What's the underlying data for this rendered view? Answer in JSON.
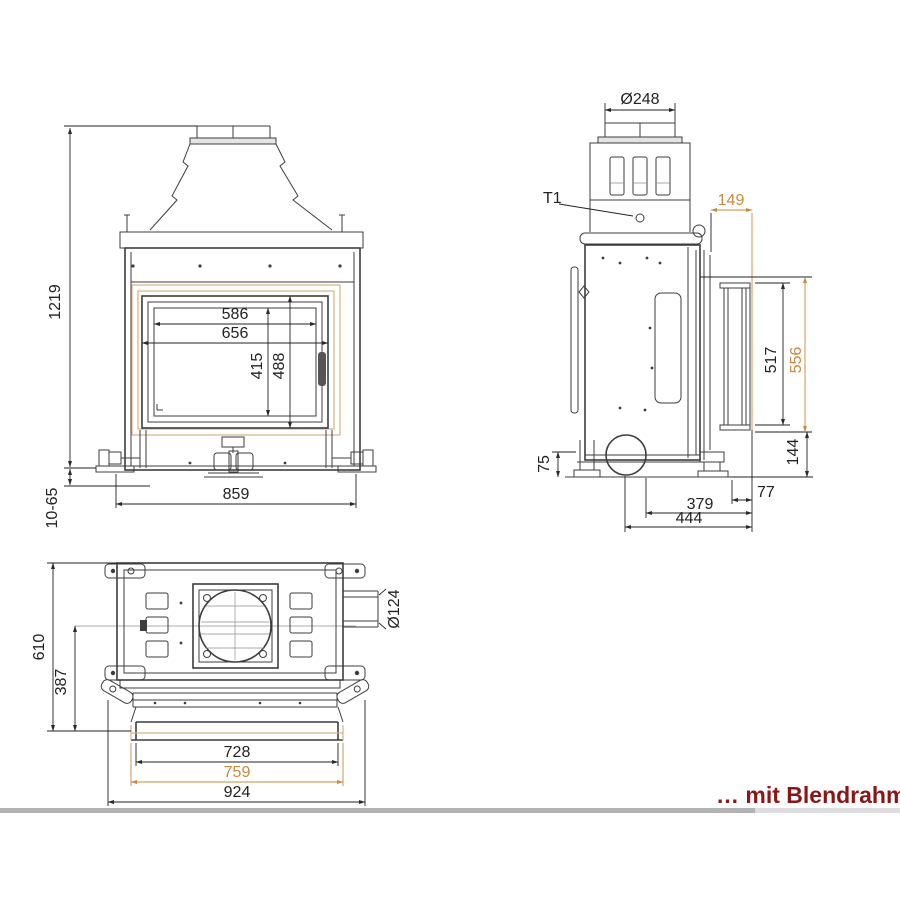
{
  "colors": {
    "line": "#3d3d3d",
    "dim_text": "#222222",
    "accent": "#c8883f",
    "accent_light": "#d9b183",
    "caption": "#8a1616",
    "scrollbar_thumb": "#b3b3b3",
    "scrollbar_track": "#dddddd",
    "background": "#ffffff"
  },
  "views": {
    "front": {
      "dims": {
        "overall_height": "1219",
        "height_adjust": "10-65",
        "glass_width": "586",
        "door_width": "656",
        "glass_height": "415",
        "door_height": "488",
        "body_width": "859"
      }
    },
    "side": {
      "flue_diameter": "Ø248",
      "sensor_label": "T1",
      "dims": {
        "frame_depth": "149",
        "opening_height": "517",
        "frame_height": "556",
        "plinth_height": "144",
        "foot_height": "75",
        "front_offset": "77",
        "body_depth": "379",
        "total_depth": "444"
      }
    },
    "top": {
      "intake_diameter": "Ø124",
      "dims": {
        "total_depth": "610",
        "body_depth": "387",
        "inner_width": "728",
        "frame_width": "759",
        "total_width": "924"
      }
    }
  },
  "caption": "… mit Blendrahmen"
}
